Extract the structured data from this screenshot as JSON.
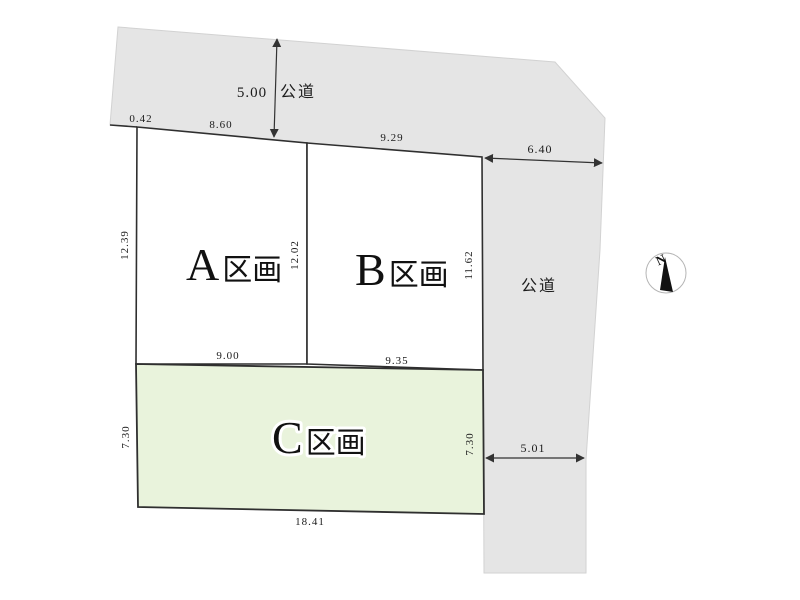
{
  "diagram": {
    "type": "land_plot_layout",
    "colors": {
      "road_fill": "#e5e5e5",
      "road_edge": "#d2d2d2",
      "plot_fill": "#ffffff",
      "plot_c_fill": "#e9f3dc",
      "boundary_line": "#2f2f2f",
      "dimension_line": "#333333",
      "text": "#1c1c1c"
    },
    "roads": {
      "top": {
        "label": "公道",
        "width_dim": "5.00"
      },
      "right": {
        "label": "公道",
        "width_dim": "5.01"
      }
    },
    "plots": [
      {
        "letter": "A",
        "suffix": "区画"
      },
      {
        "letter": "B",
        "suffix": "区画"
      },
      {
        "letter": "C",
        "suffix": "区画"
      }
    ],
    "dimensions": {
      "frontage_jog": "0.42",
      "a_frontage": "8.60",
      "b_frontage": "9.29",
      "road_east_frontage": "6.40",
      "a_west_side": "12.39",
      "ab_divider": "12.02",
      "b_east_side": "11.62",
      "a_bottom": "9.00",
      "b_bottom": "9.35",
      "c_west_side": "7.30",
      "c_east_side": "7.30",
      "c_bottom": "18.41"
    },
    "compass": {
      "label": "N"
    }
  }
}
